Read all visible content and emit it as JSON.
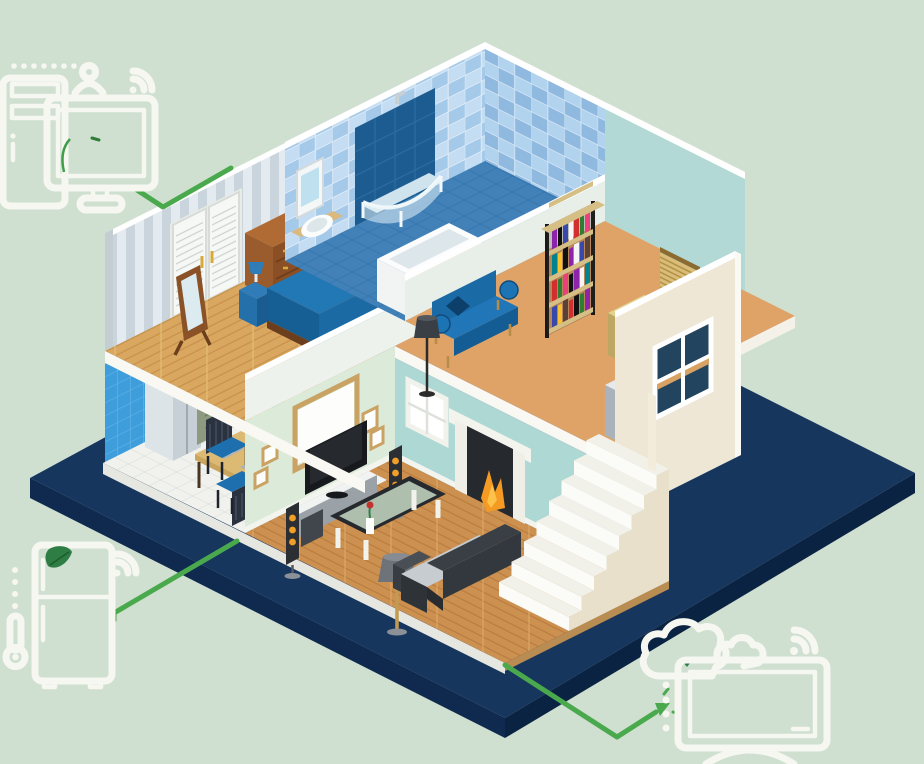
{
  "scene": {
    "name": "smart-home-isometric-cutaway",
    "description_semantic": "isometric two-story cutaway house on navy platform with connected smart-home line icons"
  },
  "palette": {
    "bg": "#cfdfd0",
    "platform_top": "#17365e",
    "platform_side_left": "#0f2a4e",
    "platform_side_right": "#0b2342",
    "green": "#4aa94c",
    "leaf": "#2e7d44",
    "icon": "#f6f7f1",
    "wood_bedroom": "#d9a75f",
    "wood_living": "#cc9150",
    "carpet": "#dfa368",
    "teal_wall": "#aed8d4",
    "mint_wall": "#dcead9",
    "stripe_wall": "#e3eaf0",
    "cream_wall": "#efe7d6",
    "kitchen_tile_blue": "#3d9edb",
    "bath_tile_light": "#c4ddf3",
    "bath_floor_blue": "#4181b8",
    "brick": "#7a4c2a",
    "furniture_blue": "#1d74b4",
    "fire_orange": "#f59a23",
    "speaker_orange": "#f0a028",
    "steel": "#c6d0d6",
    "sage_cabinet": "#a9b396",
    "tan_wood": "#d5bf85",
    "charcoal": "#33383e"
  },
  "house": {
    "rooms": [
      {
        "name": "bedroom",
        "furniture": [
          "closet-louver-doors",
          "cheval-mirror",
          "wood-dresser",
          "nightstand-lamp",
          "double-bed-blue"
        ]
      },
      {
        "name": "bathroom",
        "furniture": [
          "mirror-cabinet",
          "wall-sink",
          "corner-shower-glass",
          "bathtub"
        ]
      },
      {
        "name": "hallway-landing",
        "furniture": [
          "blue-settee",
          "black-floor-lamp",
          "bookshelf",
          "tan-dresser",
          "venetian-blinds",
          "gray-cabinet"
        ]
      },
      {
        "name": "kitchen",
        "furniture": [
          "fridge-steel",
          "window",
          "upper-cabinets",
          "range-hood",
          "stove",
          "sink-counter",
          "dining-table",
          "two-chairs"
        ]
      },
      {
        "name": "living-room",
        "furniture": [
          "tv-wall-frames",
          "flat-tv",
          "media-stand",
          "tower-speakers",
          "glass-coffee-table",
          "gray-floor-lamp",
          "sofa-charcoal",
          "fireplace",
          "window",
          "staircase"
        ]
      }
    ]
  },
  "icons": {
    "top_left": {
      "name": "smart-display-group",
      "elements": [
        "appliance-outline",
        "user-icon",
        "wifi-icon",
        "dotted-row",
        "monitor-icon",
        "leaf-icon"
      ]
    },
    "bottom_left": {
      "name": "smart-fridge-group",
      "elements": [
        "fridge-outline",
        "leaf-icon",
        "thermometer-icon",
        "dotted-column",
        "wifi-icon"
      ]
    },
    "bottom_right": {
      "name": "cloud-tv-group",
      "elements": [
        "cloud-icon",
        "small-cloud-icon",
        "leaf-icon",
        "wifi-icon",
        "monitor-icon",
        "dotted-column",
        "arrow-head"
      ]
    }
  },
  "connectors": [
    {
      "name": "monitor-to-bedroom",
      "points": [
        [
          137,
          190
        ],
        [
          163,
          207
        ],
        [
          231,
          168
        ]
      ]
    },
    {
      "name": "fridge-to-kitchen",
      "points": [
        [
          114,
          620
        ],
        [
          114,
          613
        ],
        [
          237,
          541
        ]
      ]
    },
    {
      "name": "house-to-cloud-tv",
      "points": [
        [
          505,
          665
        ],
        [
          617,
          737
        ],
        [
          660,
          709
        ]
      ],
      "arrow": true
    }
  ]
}
